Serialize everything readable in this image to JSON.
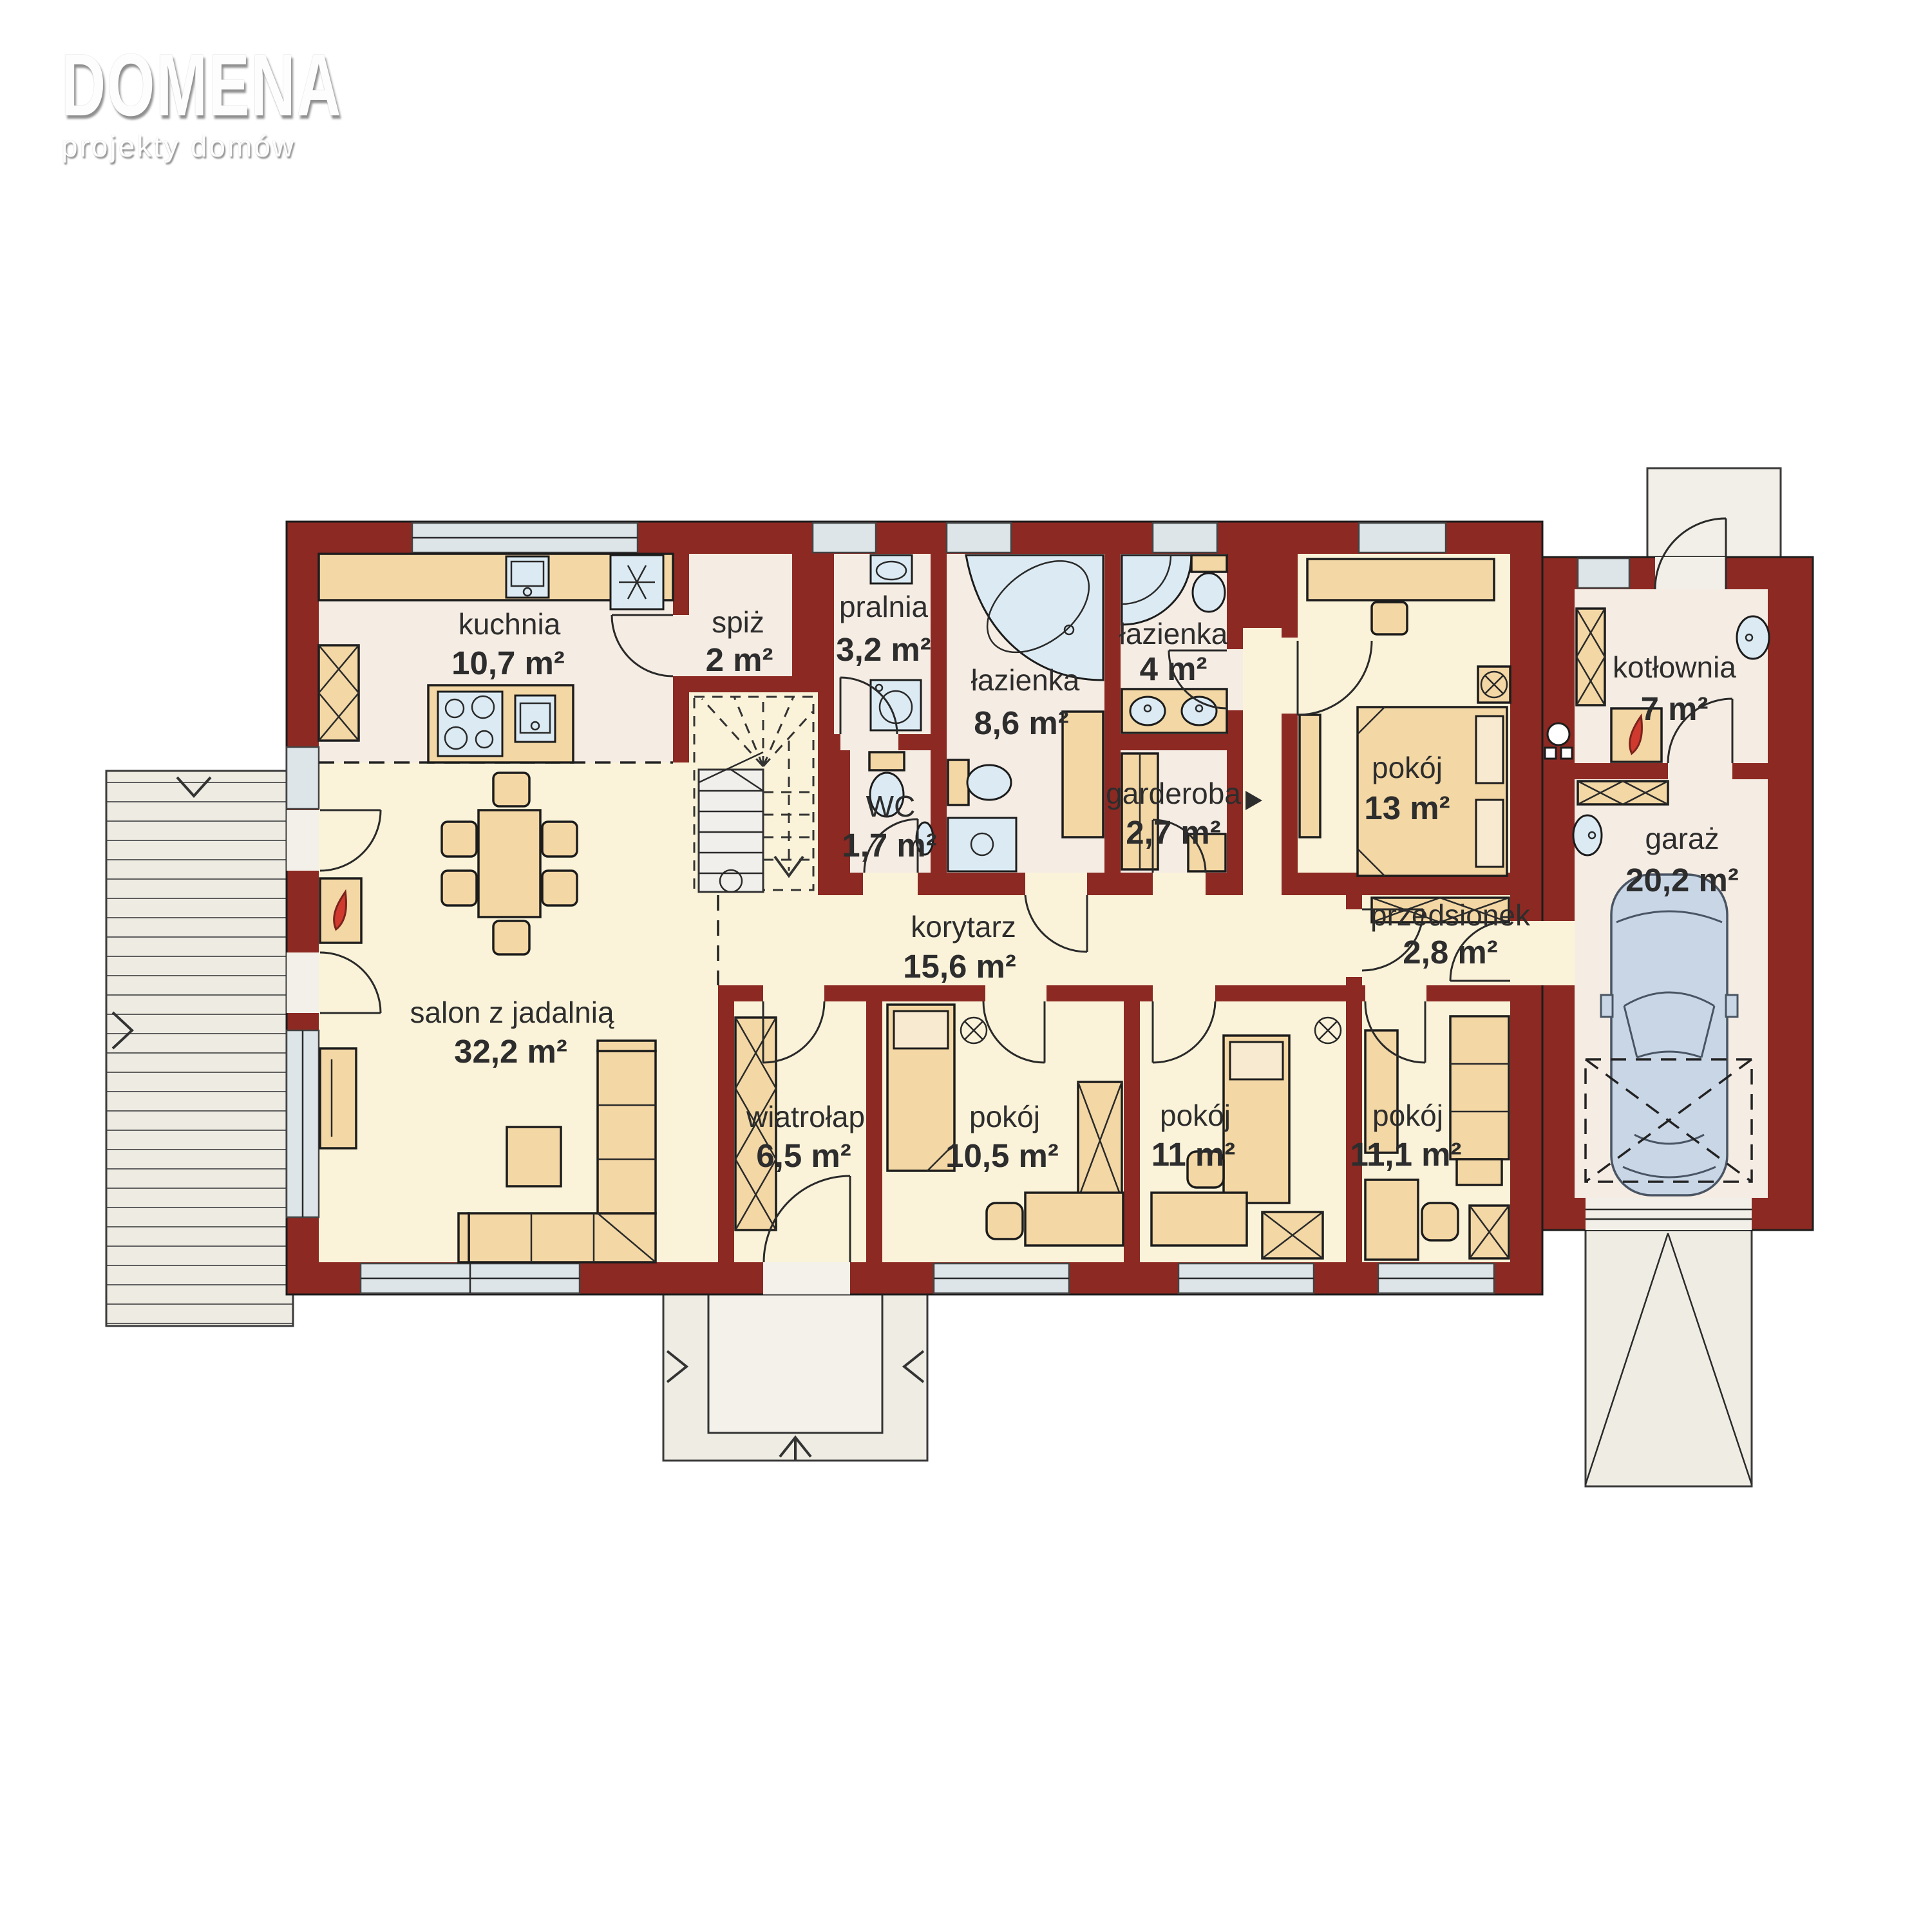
{
  "logo": {
    "title": "DOMENA",
    "subtitle": "projekty domów"
  },
  "plan": {
    "rooms": [
      {
        "key": "kuchnia",
        "label": "kuchnia",
        "area": "10,7 m²"
      },
      {
        "key": "spiz",
        "label": "spiż",
        "area": "2 m²"
      },
      {
        "key": "pralnia",
        "label": "pralnia",
        "area": "3,2 m²"
      },
      {
        "key": "wc",
        "label": "WC",
        "area": "1,7 m²"
      },
      {
        "key": "lazienka_duza",
        "label": "łazienka",
        "area": "8,6 m²"
      },
      {
        "key": "lazienka_mala",
        "label": "łazienka",
        "area": "4 m²"
      },
      {
        "key": "garderoba",
        "label": "garderoba",
        "area": "2,7 m²"
      },
      {
        "key": "pokoj_13",
        "label": "pokój",
        "area": "13 m²"
      },
      {
        "key": "kotlownia",
        "label": "kotłownia",
        "area": "7 m²"
      },
      {
        "key": "garaz",
        "label": "garaż",
        "area": "20,2 m²"
      },
      {
        "key": "korytarz",
        "label": "korytarz",
        "area": "15,6 m²"
      },
      {
        "key": "przedsionek",
        "label": "przedsionek",
        "area": "2,8 m²"
      },
      {
        "key": "salon",
        "label": "salon z jadalnią",
        "area": "32,2 m²"
      },
      {
        "key": "wiatrolap",
        "label": "wiatrołap",
        "area": "6,5 m²"
      },
      {
        "key": "pokoj_105",
        "label": "pokój",
        "area": "10,5 m²"
      },
      {
        "key": "pokoj_11",
        "label": "pokój",
        "area": "11 m²"
      },
      {
        "key": "pokoj_111",
        "label": "pokój",
        "area": "11,1 m²"
      }
    ],
    "colors": {
      "wall": "#8c2922",
      "floor_warm": "#f5ece3",
      "floor_cream": "#faf3d9",
      "furniture": "#f3d7a4",
      "fixture": "#dcebf3",
      "window_glass": "#dde5e8",
      "paving": "#eeece3",
      "car_body": "#c9d6e6",
      "flame": "#d03a2e",
      "text": "#2d2d2d"
    }
  }
}
